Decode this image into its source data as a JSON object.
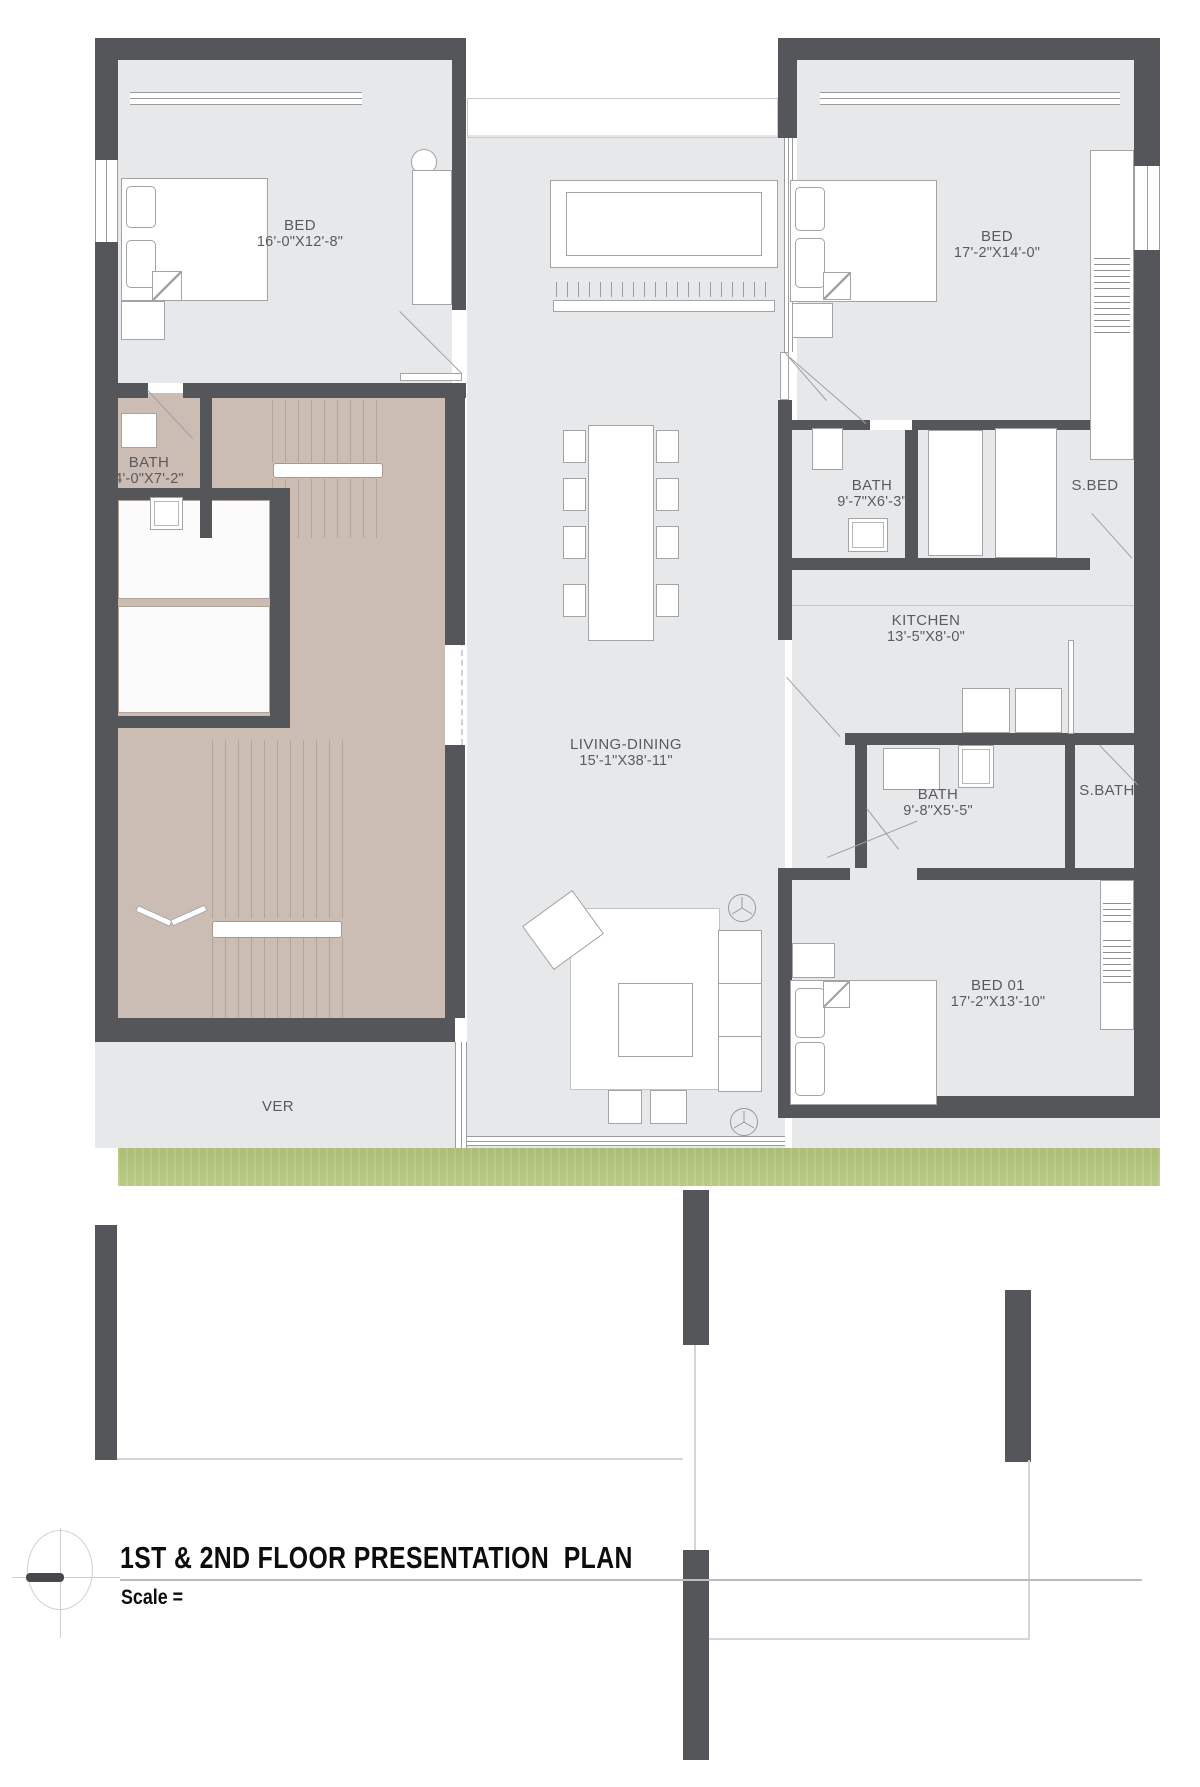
{
  "title_block": {
    "title": "1ST & 2ND FLOOR PRESENTATION  PLAN",
    "scale_label": "Scale ="
  },
  "colors": {
    "wall": "#54565a",
    "floor": "#e7e8ea",
    "taupe": "#cbbcb4",
    "grass": "#b5c77c",
    "text": "#5a5b5e",
    "title": "#0d0d0d"
  },
  "rooms": {
    "bed_top_left": {
      "name": "BED",
      "dims": "16'-0\"X12'-8\""
    },
    "bed_top_right": {
      "name": "BED",
      "dims": "17'-2\"X14'-0\""
    },
    "bath_left": {
      "name": "BATH",
      "dims": "4'-0\"X7'-2\""
    },
    "bath_mid": {
      "name": "BATH",
      "dims": "9'-7\"X6'-3\""
    },
    "s_bed": {
      "name": "S.BED"
    },
    "kitchen": {
      "name": "KITCHEN",
      "dims": "13'-5\"X8'-0\""
    },
    "living_dining": {
      "name": "LIVING-DINING",
      "dims": "15'-1\"X38'-11\""
    },
    "bath_lower": {
      "name": "BATH",
      "dims": "9'-8\"X5'-5\""
    },
    "s_bath": {
      "name": "S.BATH"
    },
    "bed_01": {
      "name": "BED 01",
      "dims": "17'-2\"X13'-10\""
    },
    "verandah": {
      "name": "VER"
    }
  }
}
